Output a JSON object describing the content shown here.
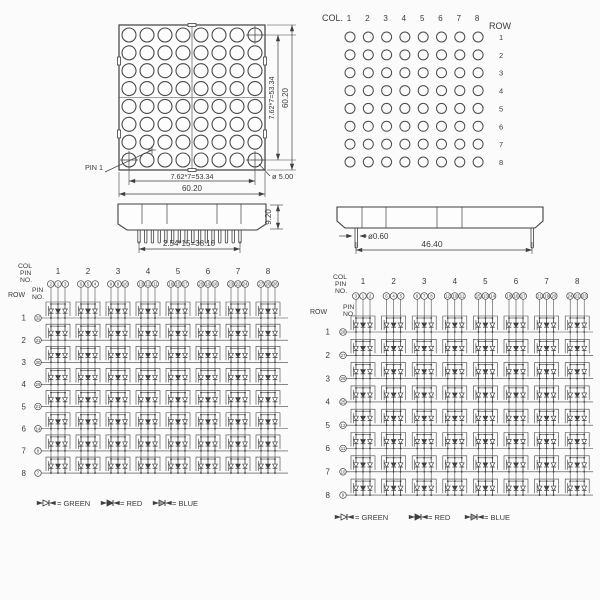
{
  "page": {
    "ink": "#3f3f3f",
    "bg": "#fbfbfb",
    "title": "8x8 RGB LED dot matrix outline drawing and internal circuit"
  },
  "front_view": {
    "rows": 8,
    "cols": 8,
    "dim_col_pitch": "7.62*7=53.34",
    "dim_width": "60.20",
    "dim_row_pitch": "7.62*7=53.34",
    "dim_height": "60.20",
    "dot_diameter": "ø 5.00",
    "pin1_label": "PIN 1"
  },
  "back_view": {
    "col_label": "COL.",
    "row_label": "ROW",
    "col_numbers": [
      "1",
      "2",
      "3",
      "4",
      "5",
      "6",
      "7",
      "8"
    ],
    "row_numbers": [
      "1",
      "2",
      "3",
      "4",
      "5",
      "6",
      "7",
      "8"
    ]
  },
  "side_view_front": {
    "dim_pin_pitch": "2.54*15=38.10",
    "dim_body_height": "9.20",
    "pin_count": 16
  },
  "side_view_side": {
    "dim_pin_diameter": "ø0.60",
    "dim_pin_span": "46.40",
    "pin_count": 2
  },
  "schematic_left": {
    "header_lines": [
      "COL",
      "PIN",
      "NO."
    ],
    "pin_no_lines": [
      "PIN",
      "NO."
    ],
    "row_label": "ROW",
    "col_numbers": [
      "1",
      "2",
      "3",
      "4",
      "5",
      "6",
      "7",
      "8"
    ],
    "col_pin_numbers": [
      [
        "2",
        "1",
        "3"
      ],
      [
        "6",
        "5",
        "4"
      ],
      [
        "9",
        "8",
        "10"
      ],
      [
        "13",
        "12",
        "11"
      ],
      [
        "16",
        "15",
        "17"
      ],
      [
        "20",
        "19",
        "18"
      ],
      [
        "23",
        "22",
        "24"
      ],
      [
        "27",
        "26",
        "28"
      ]
    ],
    "row_numbers": [
      "1",
      "2",
      "3",
      "4",
      "5",
      "6",
      "7",
      "8"
    ],
    "row_pin_numbers": [
      "32",
      "31",
      "30",
      "29",
      "21",
      "14",
      "8",
      "7"
    ],
    "legend": [
      {
        "name": "green-diode",
        "label": "= GREEN",
        "fill": "#ffffff"
      },
      {
        "name": "red-diode",
        "label": "= RED",
        "fill": "#3f3f3f"
      },
      {
        "name": "blue-diode",
        "label": "= BLUE",
        "fill": "#9e9e9e"
      }
    ]
  },
  "schematic_right": {
    "header_lines": [
      "COL",
      "PIN",
      "NO."
    ],
    "pin_no_lines": [
      "PIN",
      "NO."
    ],
    "row_label": "ROW",
    "col_numbers": [
      "1",
      "2",
      "3",
      "4",
      "5",
      "6",
      "7",
      "8"
    ],
    "col_pin_numbers": [
      [
        "3",
        "1",
        "2"
      ],
      [
        "6",
        "4",
        "5"
      ],
      [
        "9",
        "7",
        "8"
      ],
      [
        "12",
        "10",
        "11"
      ],
      [
        "15",
        "13",
        "14"
      ],
      [
        "18",
        "16",
        "17"
      ],
      [
        "21",
        "19",
        "20"
      ],
      [
        "24",
        "22",
        "23"
      ]
    ],
    "row_numbers": [
      "1",
      "2",
      "3",
      "4",
      "5",
      "6",
      "7",
      "8"
    ],
    "row_pin_numbers": [
      "28",
      "27",
      "26",
      "25",
      "12",
      "11",
      "10",
      "9"
    ],
    "legend": [
      {
        "name": "green-diode",
        "label": "= GREEN",
        "fill": "#ffffff"
      },
      {
        "name": "red-diode",
        "label": "= RED",
        "fill": "#3f3f3f"
      },
      {
        "name": "blue-diode",
        "label": "= BLUE",
        "fill": "#9e9e9e"
      }
    ]
  }
}
